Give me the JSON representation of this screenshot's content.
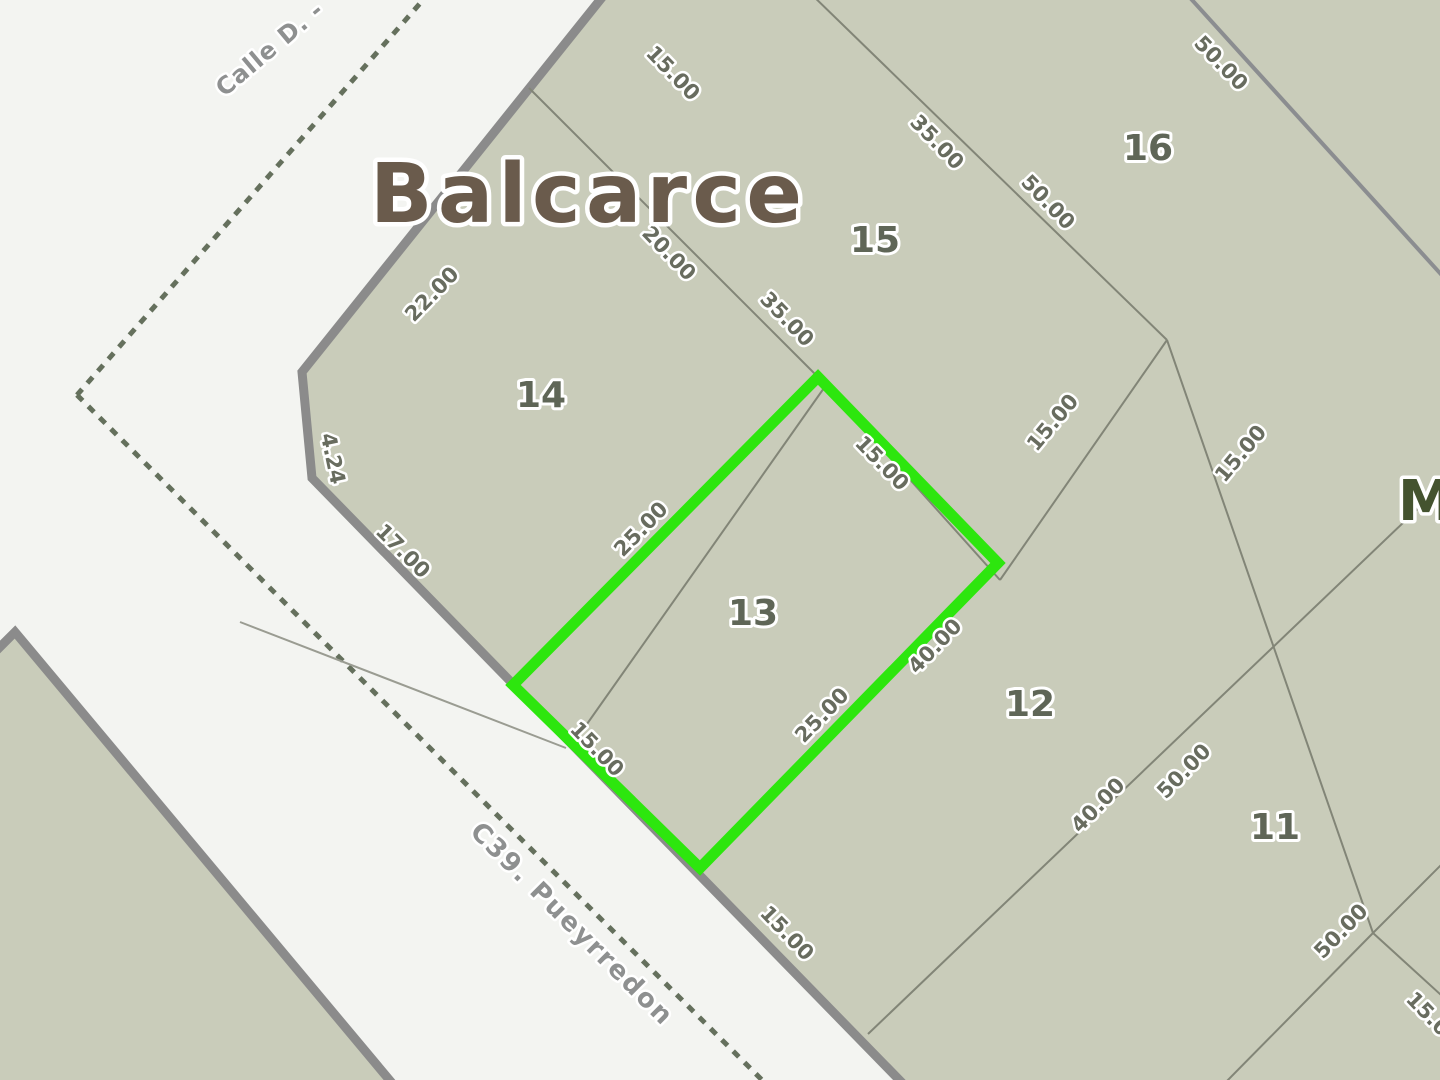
{
  "map": {
    "title": "Balcarce",
    "adjacent_block_label": "M",
    "selected_parcel": "13",
    "colors": {
      "land_fill": "#c9ccba",
      "street_background": "#f3f4f1",
      "street_border": "#8b8b8b",
      "parcel_line": "#828577",
      "block_boundary_line": "#8b8d90",
      "selection_green": "#2de60e",
      "dashed_line": "#55624c",
      "title_brown": "#6a5b4c",
      "label_gray_green": "#686c5f"
    },
    "streets": [
      {
        "name": "Calle D. -",
        "x": 275,
        "y": 55,
        "rot": -40,
        "size": 24,
        "spacing": 1
      },
      {
        "name": "C39. Pueyrredon",
        "x": 566,
        "y": 930,
        "rot": 45,
        "size": 26,
        "spacing": 2
      }
    ],
    "parcels": [
      {
        "id": "14",
        "x": 541,
        "y": 407
      },
      {
        "id": "15",
        "x": 875,
        "y": 252
      },
      {
        "id": "16",
        "x": 1148,
        "y": 160
      },
      {
        "id": "13",
        "x": 753,
        "y": 625
      },
      {
        "id": "12",
        "x": 1030,
        "y": 716
      },
      {
        "id": "11",
        "x": 1275,
        "y": 839
      }
    ],
    "dimensions": [
      {
        "t": "15.00",
        "x": 668,
        "y": 78,
        "r": 46
      },
      {
        "t": "35.00",
        "x": 932,
        "y": 147,
        "r": 46
      },
      {
        "t": "50.00",
        "x": 1216,
        "y": 68,
        "r": 46
      },
      {
        "t": "50.00",
        "x": 1043,
        "y": 207,
        "r": 46
      },
      {
        "t": "20.00",
        "x": 664,
        "y": 258,
        "r": 46
      },
      {
        "t": "35.00",
        "x": 782,
        "y": 324,
        "r": 46
      },
      {
        "t": "22.00",
        "x": 437,
        "y": 299,
        "r": -46
      },
      {
        "t": "4.24",
        "x": 326,
        "y": 460,
        "r": 78
      },
      {
        "t": "17.00",
        "x": 398,
        "y": 556,
        "r": 45
      },
      {
        "t": "25.00",
        "x": 646,
        "y": 534,
        "r": -46
      },
      {
        "t": "15.00",
        "x": 877,
        "y": 468,
        "r": 46
      },
      {
        "t": "15.00",
        "x": 1058,
        "y": 427,
        "r": -50
      },
      {
        "t": "15.00",
        "x": 1246,
        "y": 458,
        "r": -50
      },
      {
        "t": "25.00",
        "x": 827,
        "y": 720,
        "r": -46
      },
      {
        "t": "40.00",
        "x": 940,
        "y": 651,
        "r": -46
      },
      {
        "t": "15.00",
        "x": 592,
        "y": 754,
        "r": 46
      },
      {
        "t": "15.00",
        "x": 782,
        "y": 938,
        "r": 46
      },
      {
        "t": "40.00",
        "x": 1103,
        "y": 810,
        "r": -46
      },
      {
        "t": "50.00",
        "x": 1189,
        "y": 776,
        "r": -46
      },
      {
        "t": "50.00",
        "x": 1346,
        "y": 936,
        "r": -46
      },
      {
        "t": "15.00",
        "x": 1428,
        "y": 1024,
        "r": 46
      }
    ]
  }
}
